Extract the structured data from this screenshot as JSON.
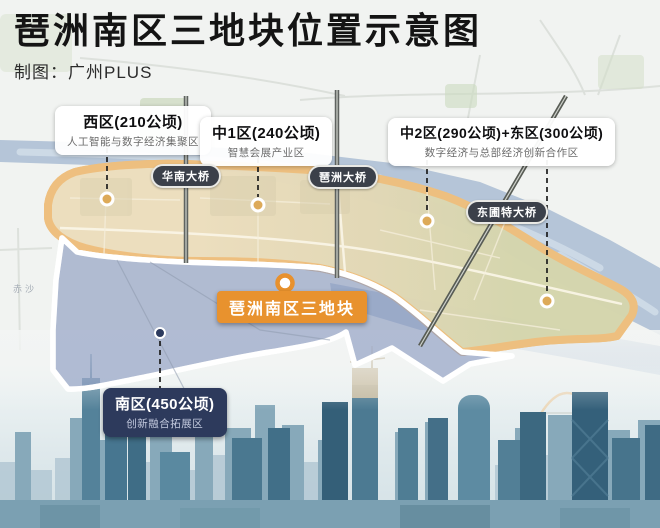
{
  "header": {
    "title": "琶洲南区三地块位置示意图",
    "credit": "制图：广州PLUS"
  },
  "zones": {
    "west": {
      "title": "西区(210公顷)",
      "subtitle": "人工智能与数字经济集聚区"
    },
    "central1": {
      "title": "中1区(240公顷)",
      "subtitle": "智慧会展产业区"
    },
    "central2_east": {
      "title": "中2区(290公顷)+东区(300公顷)",
      "subtitle": "数字经济与总部经济创新合作区"
    },
    "south": {
      "title": "南区(450公顷)",
      "subtitle": "创新融合拓展区"
    }
  },
  "highlight": {
    "label": "琶洲南区三地块"
  },
  "bridges": {
    "huanan": "华南大桥",
    "pazhou": "琶洲大桥",
    "dongpu": "东圃特大桥"
  },
  "map_labels": {
    "chisha": "赤沙"
  },
  "colors": {
    "island_border": "#dfa04f",
    "island_fill_west": "#ecdebe",
    "island_fill_east": "#d5d6ae",
    "highlight_bg": "#e8922e",
    "south_box_bg": "#2d3a5c",
    "navy_border": "#2b3a5e",
    "water": "#b5c5d8",
    "bridge_pill_bg": "#3b404a"
  }
}
